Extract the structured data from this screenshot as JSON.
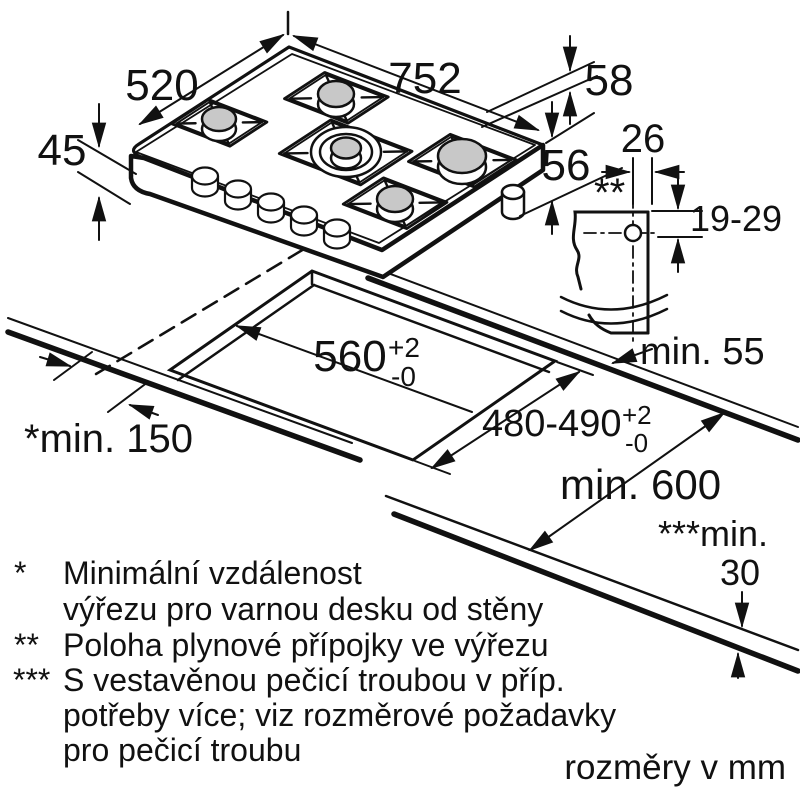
{
  "diagram": {
    "hob": {
      "width": "752",
      "depth": "520",
      "height": "45",
      "grate_height": "58",
      "connection_drop": "56"
    },
    "gas_detail": {
      "offset": "26",
      "marker": "**",
      "vertical_range": "19-29",
      "rear_clearance": "min. 55"
    },
    "cutout": {
      "width": "560",
      "width_tol_plus": "+2",
      "width_tol_minus": "-0",
      "depth": "480-490",
      "depth_tol_plus": "+2",
      "depth_tol_minus": "-0",
      "wall_clearance": "*min. 150",
      "worktop_depth": "min. 600",
      "oven_gap_label": "***min.",
      "oven_gap_value": "30"
    },
    "footnotes": [
      {
        "marker": "*",
        "lines": [
          "Minimální vzdálenost",
          "výřezu pro varnou desku od stěny"
        ]
      },
      {
        "marker": "**",
        "lines": [
          "Poloha plynové přípojky ve výřezu"
        ]
      },
      {
        "marker": "***",
        "lines": [
          "S vestavěnou pečicí troubou v příp.",
          "potřeby více; viz rozměrové požadavky",
          "pro pečicí troubu"
        ]
      }
    ],
    "units_note": "rozměry v mm"
  }
}
